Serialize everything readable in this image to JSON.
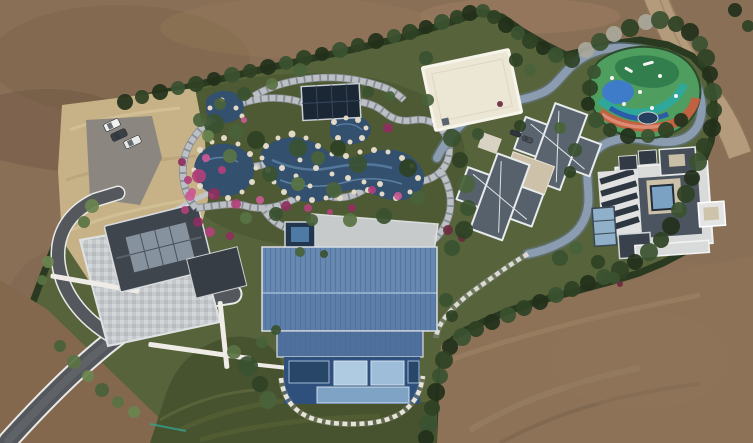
{
  "scene": {
    "palette": {
      "dirt": "#8a6f57",
      "dirtDark": "#6e563f",
      "dirtLight": "#a18669",
      "sandRoad": "#b49b7c",
      "dryGrass": "#c7b287",
      "hedge": "#2a3a20",
      "garden": "#57633a",
      "gardenDeep": "#4e5a33",
      "lawn": "#47522e",
      "stone": "#bcc0c5",
      "stoneJoint": "#878d94",
      "road": "#8c9cb0",
      "roadEdge": "#65788e",
      "stepping": "#dcdad2",
      "pond": "#33506e",
      "pondLight": "#5c82a8",
      "rock": "#e2dac6",
      "blueRoof": "#5c7ea9",
      "blueRoofLight": "#7191b8",
      "blueRoofLower": "#4f6f9c",
      "blueWall": "#2f4f7c",
      "windowGlass": "#aecbe2",
      "slateRoof": "#3f454d",
      "slateWing": "#373d45",
      "skylight": "#8e9aa6",
      "grayRoof": "#5a646f",
      "grayRoof2": "#57616c",
      "whiteTrim": "#eef0ef",
      "creamRoof": "#ece6d5",
      "eastBase": "#d9dbda",
      "darkSection": "#4c555f",
      "courtyardGlass": "#7ba2c2",
      "tanFlat": "#cdc2a9",
      "asphalt": "#54575c",
      "parking": "#8b8680",
      "patio": "#c6c9cb",
      "wallWhite": "#efece7",
      "pavilion": "#1c2735",
      "spa": "#22364d",
      "playGreen": "#4f9e5f",
      "playDark": "#2f7a4a",
      "playBlue": "#3e7bc8",
      "playTeal": "#2fa89b",
      "playRed": "#cc5a3d",
      "playSalmon": "#e2927f",
      "playNavy": "#2b5ca8"
    },
    "trees": {
      "colors": [
        "#22301b",
        "#2e4224",
        "#3a5230",
        "#49623a",
        "#597344",
        "#6b8450",
        "#7e9458",
        "#a9a89b",
        "#90a068"
      ],
      "items": [
        [
          125,
          102,
          8,
          0
        ],
        [
          142,
          97,
          7,
          1
        ],
        [
          160,
          92,
          8,
          0
        ],
        [
          178,
          88,
          7,
          2
        ],
        [
          196,
          84,
          8,
          1
        ],
        [
          214,
          79,
          7,
          0
        ],
        [
          232,
          75,
          8,
          2
        ],
        [
          250,
          71,
          7,
          1
        ],
        [
          268,
          67,
          8,
          0
        ],
        [
          286,
          63,
          7,
          2
        ],
        [
          304,
          58,
          8,
          1
        ],
        [
          322,
          54,
          7,
          0
        ],
        [
          340,
          50,
          8,
          2
        ],
        [
          358,
          45,
          7,
          1
        ],
        [
          376,
          41,
          8,
          0
        ],
        [
          394,
          36,
          7,
          2
        ],
        [
          410,
          32,
          8,
          1
        ],
        [
          426,
          27,
          7,
          0
        ],
        [
          442,
          22,
          8,
          2
        ],
        [
          457,
          17,
          7,
          1
        ],
        [
          470,
          13,
          8,
          0
        ],
        [
          483,
          11,
          7,
          2
        ],
        [
          494,
          17,
          7,
          1
        ],
        [
          506,
          25,
          8,
          0
        ],
        [
          518,
          33,
          7,
          2
        ],
        [
          530,
          41,
          8,
          1
        ],
        [
          543,
          48,
          7,
          0
        ],
        [
          556,
          55,
          8,
          2
        ],
        [
          572,
          60,
          8,
          1
        ],
        [
          586,
          50,
          8,
          7
        ],
        [
          600,
          42,
          9,
          2
        ],
        [
          614,
          34,
          8,
          7
        ],
        [
          630,
          28,
          9,
          1
        ],
        [
          646,
          22,
          8,
          7
        ],
        [
          660,
          20,
          9,
          2
        ],
        [
          676,
          24,
          8,
          1
        ],
        [
          690,
          32,
          9,
          0
        ],
        [
          700,
          44,
          8,
          2
        ],
        [
          706,
          58,
          9,
          1
        ],
        [
          710,
          74,
          8,
          0
        ],
        [
          713,
          92,
          9,
          2
        ],
        [
          714,
          110,
          8,
          1
        ],
        [
          712,
          128,
          9,
          0
        ],
        [
          704,
          146,
          8,
          1
        ],
        [
          698,
          162,
          9,
          2
        ],
        [
          692,
          178,
          8,
          0
        ],
        [
          686,
          194,
          9,
          1
        ],
        [
          679,
          210,
          8,
          2
        ],
        [
          671,
          226,
          9,
          0
        ],
        [
          661,
          240,
          8,
          1
        ],
        [
          649,
          252,
          9,
          2
        ],
        [
          635,
          262,
          8,
          0
        ],
        [
          620,
          270,
          9,
          1
        ],
        [
          604,
          277,
          8,
          2
        ],
        [
          588,
          283,
          8,
          0
        ],
        [
          572,
          289,
          8,
          1
        ],
        [
          556,
          295,
          8,
          2
        ],
        [
          540,
          302,
          8,
          0
        ],
        [
          524,
          308,
          8,
          1
        ],
        [
          508,
          315,
          8,
          2
        ],
        [
          492,
          322,
          8,
          0
        ],
        [
          476,
          329,
          8,
          1
        ],
        [
          462,
          337,
          9,
          2
        ],
        [
          450,
          347,
          8,
          0
        ],
        [
          444,
          360,
          9,
          1
        ],
        [
          440,
          376,
          8,
          2
        ],
        [
          436,
          392,
          9,
          0
        ],
        [
          432,
          408,
          8,
          1
        ],
        [
          428,
          424,
          9,
          2
        ],
        [
          426,
          438,
          8,
          0
        ],
        [
          594,
          72,
          7,
          2
        ],
        [
          590,
          88,
          8,
          1
        ],
        [
          588,
          104,
          7,
          0
        ],
        [
          596,
          120,
          8,
          2
        ],
        [
          610,
          130,
          7,
          1
        ],
        [
          628,
          136,
          8,
          0
        ],
        [
          648,
          136,
          7,
          2
        ],
        [
          666,
          130,
          8,
          1
        ],
        [
          681,
          120,
          7,
          0
        ],
        [
          214,
          124,
          10,
          2
        ],
        [
          236,
          132,
          8,
          3
        ],
        [
          256,
          140,
          9,
          1
        ],
        [
          230,
          156,
          7,
          4
        ],
        [
          298,
          148,
          9,
          2
        ],
        [
          318,
          158,
          7,
          3
        ],
        [
          338,
          148,
          8,
          1
        ],
        [
          358,
          164,
          9,
          2
        ],
        [
          298,
          184,
          7,
          4
        ],
        [
          334,
          190,
          8,
          3
        ],
        [
          270,
          174,
          8,
          2
        ],
        [
          408,
          168,
          9,
          1
        ],
        [
          418,
          198,
          7,
          3
        ],
        [
          384,
          216,
          8,
          2
        ],
        [
          350,
          220,
          7,
          4
        ],
        [
          312,
          220,
          6,
          3
        ],
        [
          276,
          214,
          7,
          2
        ],
        [
          246,
          218,
          6,
          4
        ],
        [
          200,
          120,
          7,
          3
        ],
        [
          208,
          136,
          6,
          5
        ],
        [
          452,
          138,
          9,
          2
        ],
        [
          460,
          160,
          8,
          1
        ],
        [
          466,
          184,
          9,
          3
        ],
        [
          468,
          208,
          8,
          2
        ],
        [
          464,
          230,
          9,
          1
        ],
        [
          452,
          248,
          8,
          2
        ],
        [
          300,
          70,
          7,
          3
        ],
        [
          272,
          84,
          6,
          4
        ],
        [
          244,
          94,
          7,
          2
        ],
        [
          220,
          104,
          6,
          3
        ],
        [
          426,
          58,
          7,
          2
        ],
        [
          428,
          100,
          6,
          3
        ],
        [
          520,
          126,
          6,
          1
        ],
        [
          478,
          134,
          6,
          2
        ],
        [
          560,
          128,
          6,
          3
        ],
        [
          575,
          150,
          7,
          2
        ],
        [
          570,
          172,
          6,
          1
        ],
        [
          516,
          60,
          7,
          1
        ],
        [
          530,
          70,
          6,
          3
        ],
        [
          368,
          92,
          6,
          2
        ],
        [
          390,
          96,
          5,
          3
        ],
        [
          446,
          300,
          7,
          2
        ],
        [
          452,
          316,
          6,
          1
        ],
        [
          262,
          342,
          6,
          3
        ],
        [
          276,
          330,
          5,
          2
        ],
        [
          248,
          366,
          10,
          2
        ],
        [
          260,
          384,
          8,
          1
        ],
        [
          268,
          400,
          9,
          3
        ],
        [
          234,
          352,
          7,
          4
        ],
        [
          560,
          258,
          8,
          2
        ],
        [
          576,
          248,
          7,
          3
        ],
        [
          598,
          262,
          7,
          1
        ],
        [
          614,
          278,
          6,
          2
        ],
        [
          92,
          206,
          7,
          5
        ],
        [
          84,
          222,
          6,
          4
        ],
        [
          48,
          262,
          6,
          5
        ],
        [
          42,
          280,
          5,
          4
        ],
        [
          74,
          362,
          7,
          4
        ],
        [
          88,
          376,
          6,
          5
        ],
        [
          102,
          390,
          7,
          3
        ],
        [
          118,
          402,
          6,
          4
        ],
        [
          134,
          412,
          6,
          5
        ],
        [
          60,
          346,
          6,
          3
        ],
        [
          300,
          252,
          5,
          3
        ],
        [
          324,
          254,
          4,
          2
        ],
        [
          735,
          10,
          7,
          0
        ],
        [
          748,
          26,
          6,
          1
        ]
      ]
    },
    "rocks": [
      [
        200,
        150,
        3
      ],
      [
        212,
        142,
        2.5
      ],
      [
        224,
        138,
        3
      ],
      [
        238,
        144,
        2.5
      ],
      [
        250,
        154,
        3
      ],
      [
        256,
        168,
        2.5
      ],
      [
        252,
        182,
        3
      ],
      [
        242,
        192,
        2.5
      ],
      [
        228,
        198,
        3
      ],
      [
        212,
        196,
        2.5
      ],
      [
        200,
        186,
        3
      ],
      [
        194,
        170,
        2.5
      ],
      [
        266,
        146,
        3
      ],
      [
        278,
        138,
        2.5
      ],
      [
        292,
        134,
        3.5
      ],
      [
        306,
        138,
        2.5
      ],
      [
        318,
        146,
        3
      ],
      [
        332,
        154,
        2.5
      ],
      [
        346,
        156,
        3
      ],
      [
        360,
        152,
        2.5
      ],
      [
        374,
        150,
        3
      ],
      [
        388,
        152,
        2.5
      ],
      [
        402,
        158,
        3
      ],
      [
        412,
        166,
        2.5
      ],
      [
        418,
        178,
        3
      ],
      [
        410,
        192,
        2.5
      ],
      [
        396,
        198,
        3
      ],
      [
        382,
        194,
        2.5
      ],
      [
        368,
        190,
        3
      ],
      [
        354,
        192,
        2.5
      ],
      [
        340,
        198,
        3
      ],
      [
        326,
        198,
        2.5
      ],
      [
        312,
        200,
        3
      ],
      [
        298,
        198,
        2.5
      ],
      [
        284,
        192,
        3
      ],
      [
        274,
        182,
        2.5
      ],
      [
        268,
        170,
        3
      ],
      [
        262,
        158,
        2.5
      ],
      [
        334,
        122,
        3
      ],
      [
        346,
        118,
        2.5
      ],
      [
        358,
        120,
        3
      ],
      [
        366,
        128,
        2.5
      ],
      [
        362,
        138,
        3
      ],
      [
        350,
        142,
        2.5
      ],
      [
        338,
        138,
        3
      ],
      [
        300,
        160,
        2.5
      ],
      [
        316,
        168,
        3
      ],
      [
        332,
        174,
        2.5
      ],
      [
        348,
        178,
        3
      ],
      [
        364,
        182,
        2.5
      ],
      [
        380,
        184,
        3
      ],
      [
        296,
        176,
        2.5
      ],
      [
        282,
        168,
        3
      ],
      [
        310,
        186,
        2.5
      ],
      [
        210,
        108,
        2.5
      ],
      [
        222,
        100,
        2.5
      ],
      [
        236,
        108,
        2.5
      ],
      [
        242,
        116,
        2.5
      ]
    ],
    "flowers": {
      "colors": [
        "#b2407a",
        "#8e2f5e",
        "#c95a92",
        "#6d2b3f"
      ],
      "items": [
        [
          199,
          176,
          7,
          0
        ],
        [
          214,
          194,
          6,
          1
        ],
        [
          236,
          204,
          5,
          0
        ],
        [
          260,
          200,
          4,
          2
        ],
        [
          286,
          206,
          5,
          1
        ],
        [
          308,
          208,
          4,
          0
        ],
        [
          206,
          158,
          4,
          2
        ],
        [
          222,
          170,
          4,
          0
        ],
        [
          388,
          128,
          5,
          1
        ],
        [
          372,
          190,
          4,
          0
        ],
        [
          398,
          196,
          4,
          2
        ],
        [
          448,
          230,
          5,
          3
        ],
        [
          462,
          238,
          4,
          3
        ],
        [
          500,
          104,
          3,
          3
        ],
        [
          608,
          276,
          4,
          3
        ],
        [
          620,
          284,
          3,
          3
        ],
        [
          352,
          208,
          4,
          1
        ],
        [
          330,
          212,
          3,
          0
        ],
        [
          244,
          120,
          3,
          2
        ],
        [
          198,
          222,
          5,
          1
        ],
        [
          185,
          210,
          4,
          0
        ],
        [
          230,
          236,
          4,
          1
        ],
        [
          210,
          232,
          5,
          0
        ],
        [
          190,
          196,
          5,
          2
        ],
        [
          182,
          162,
          4,
          1
        ],
        [
          188,
          180,
          4,
          0
        ],
        [
          192,
          192,
          4,
          2
        ]
      ]
    },
    "cars": [
      {
        "x": 104,
        "y": 121,
        "w": 16,
        "h": 8,
        "rot": -25,
        "color": "#f1f1ef"
      },
      {
        "x": 111,
        "y": 131,
        "w": 16,
        "h": 8,
        "rot": -25,
        "color": "#3b4047"
      },
      {
        "x": 124,
        "y": 138,
        "w": 17,
        "h": 8,
        "rot": -25,
        "color": "#e8e9e9"
      },
      {
        "x": 510,
        "y": 131,
        "w": 11,
        "h": 5,
        "rot": 20,
        "color": "#2f353c"
      },
      {
        "x": 522,
        "y": 137,
        "w": 11,
        "h": 5,
        "rot": 20,
        "color": "#4a5056"
      }
    ]
  }
}
